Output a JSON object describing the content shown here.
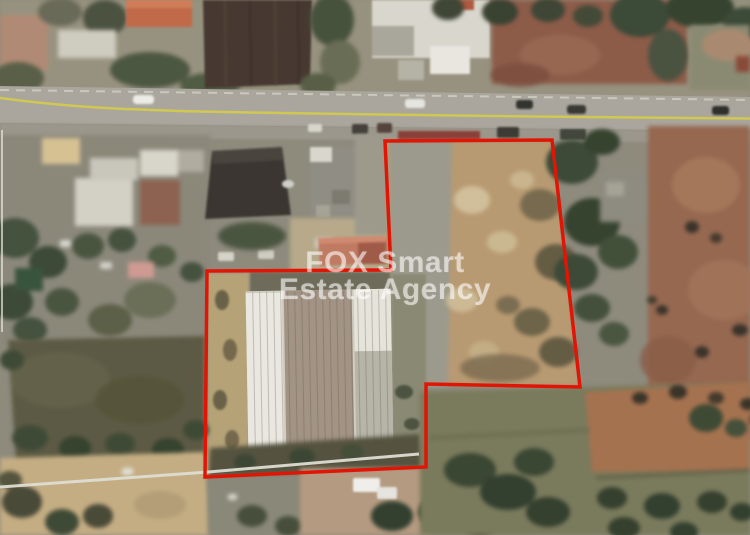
{
  "image": {
    "kind": "satellite-aerial-photo",
    "subject": "land plot with warehouse outlined in red beside a road"
  },
  "watermark": {
    "line1": "FOX Smart",
    "line2": "Estate Agency"
  },
  "boundary": {
    "label": "plot-boundary",
    "color": "#e01505",
    "points": "385,141 552,140 580,387 426,384 426,467 205,477 207,271 391,270"
  },
  "overlay_lines": {
    "wall_line_points": "0,487 208,472 419,454",
    "left_edge_line_points": "2,130 2,332"
  },
  "road": {
    "surface_color": "#a9a59c",
    "center_line_color": "#d4cc4a",
    "center_line_path": "M0,98 C60,106 110,109 180,111 C300,114 430,115 530,116.5 C620,117.5 690,118 750,118.5"
  },
  "scene_colors": {
    "base": "#8e8b7d",
    "plowed_field": "#473931",
    "bare_soil_right": "#966850",
    "dark_field_left": "#5c5a44",
    "tan_ground": "#c4ad83",
    "warehouse_roof_light": "#e9e7df",
    "warehouse_roof_taupe": "#a29384",
    "tree_green": "#3f4a37",
    "salmon_roof": "#bf7a62",
    "dark_building_roof": "#3b3632"
  }
}
